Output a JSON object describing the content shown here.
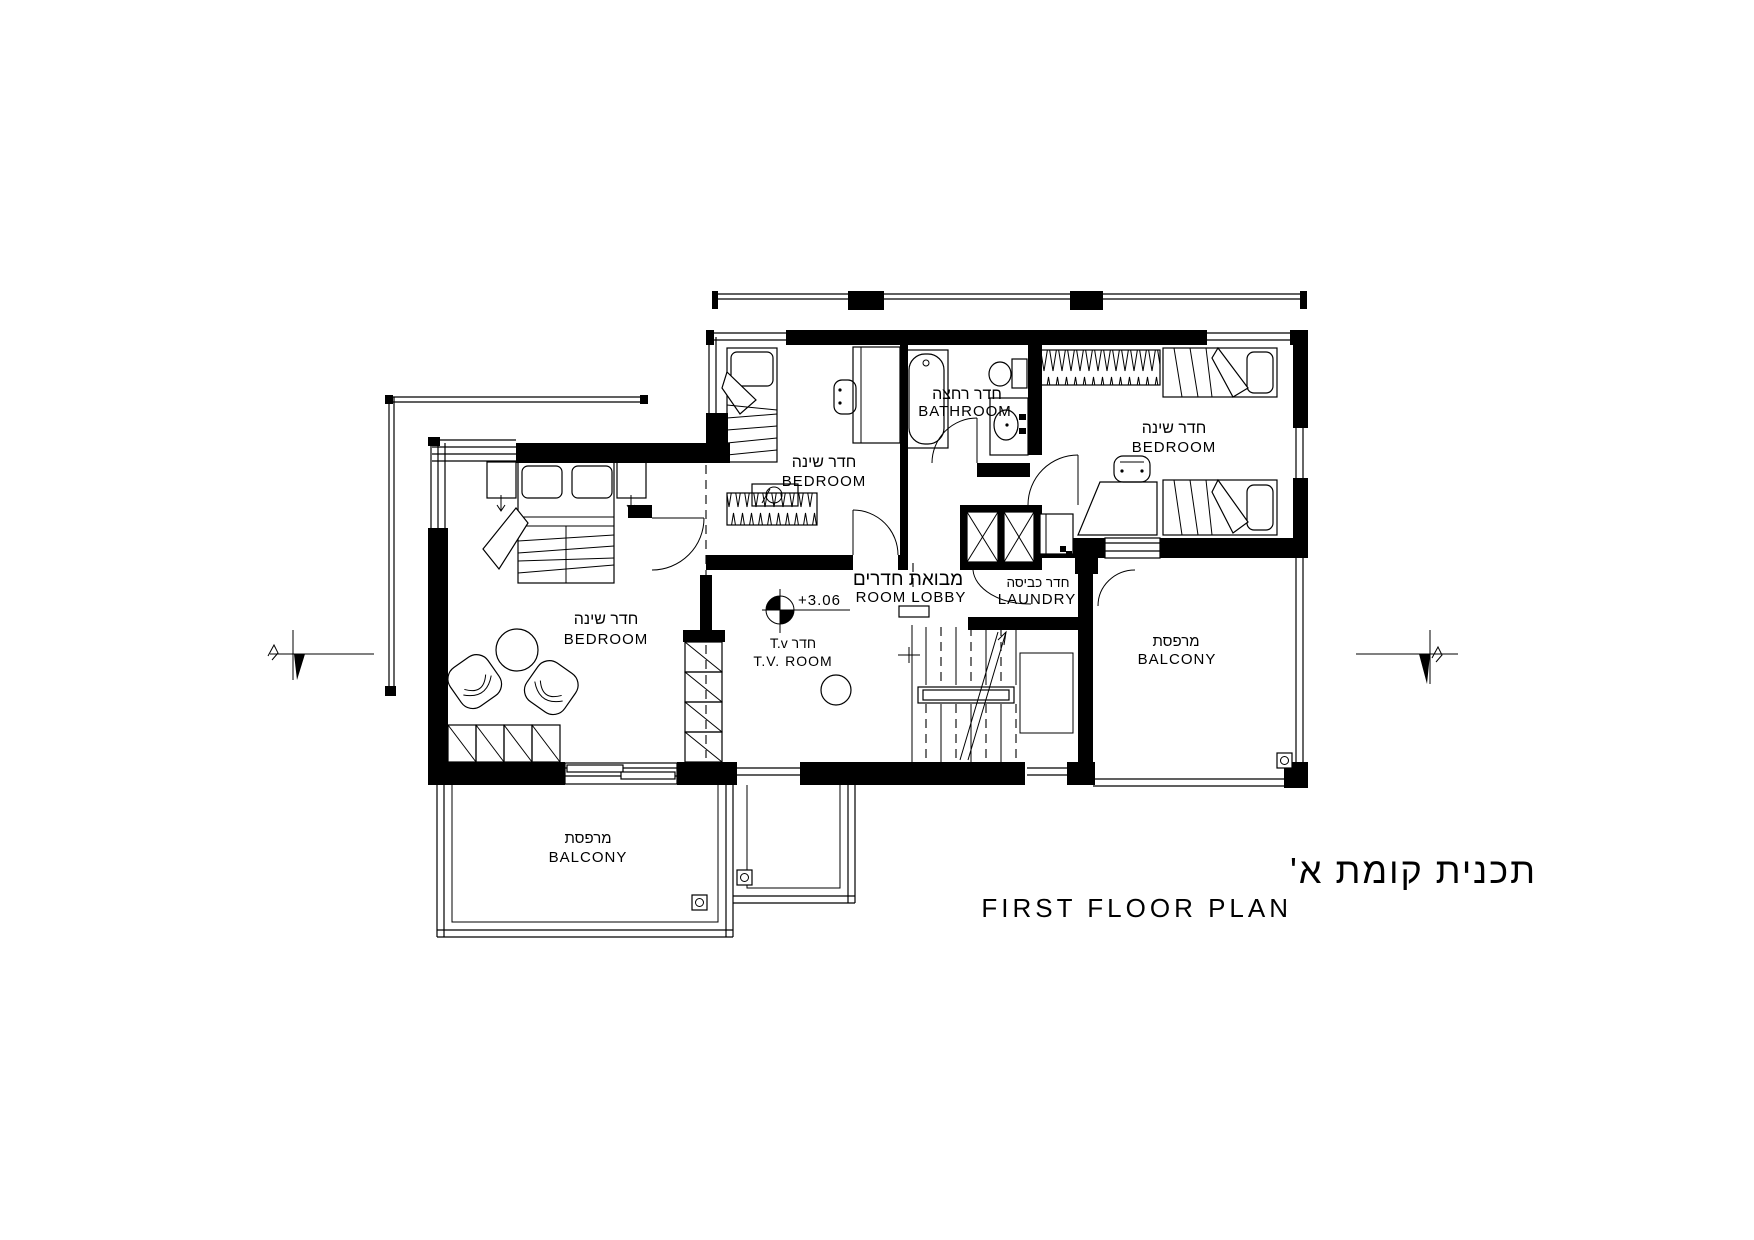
{
  "title": {
    "hebrew": "תכנית קומת א'",
    "english": "FIRST FLOOR PLAN"
  },
  "annotations": {
    "level": "+3.06"
  },
  "rooms": {
    "bathroom": {
      "hebrew": "חדר רחצה",
      "english": "BATHROOM"
    },
    "bedroom_top": {
      "hebrew": "חדר שינה",
      "english": "BEDROOM"
    },
    "bedroom_right": {
      "hebrew": "חדר שינה",
      "english": "BEDROOM"
    },
    "bedroom_master": {
      "hebrew": "חדר שינה",
      "english": "BEDROOM"
    },
    "lobby": {
      "hebrew": "מבואת חדרים",
      "english": "ROOM LOBBY"
    },
    "laundry": {
      "hebrew": "חדר כביסה",
      "english": "LAUNDRY"
    },
    "tv_room": {
      "hebrew": "חדר T.v",
      "english": "T.V. ROOM"
    },
    "balcony_right": {
      "hebrew": "מרפסת",
      "english": "BALCONY"
    },
    "balcony_lower": {
      "hebrew": "מרפסת",
      "english": "BALCONY"
    }
  },
  "colors": {
    "ink": "#000000",
    "paper": "#ffffff"
  }
}
